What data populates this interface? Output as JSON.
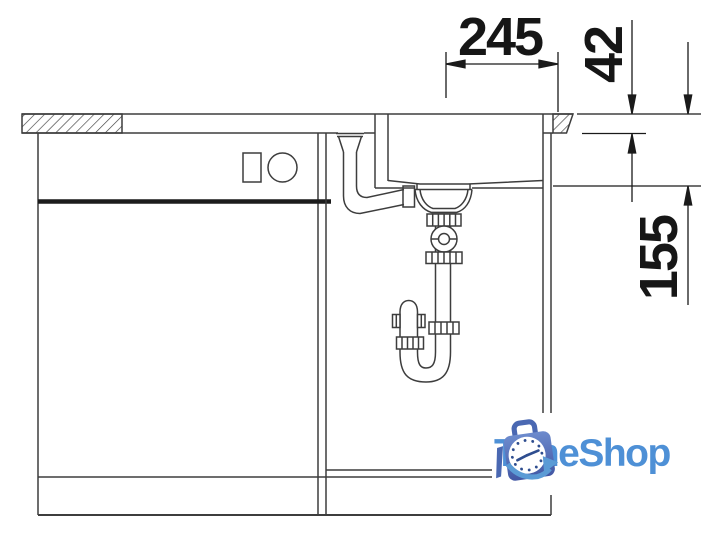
{
  "diagram": {
    "kind": "sink-installation-side-view-drawing",
    "dimension_labels": {
      "horizontal_top": "245",
      "vertical_top": "42",
      "vertical_right": "155"
    }
  },
  "logo": {
    "text": "TimeShop",
    "icon": "clock-in-shopping-bag",
    "text_color": "#4E90D6",
    "bag_color_top": "#6d8bcd",
    "bag_color_bottom": "#4257a4",
    "swoosh_color": "#5b9bd5"
  },
  "colors": {
    "background": "#ffffff",
    "drawing_line": "#3d3d3d",
    "dimension_line": "#1a1a1a"
  }
}
